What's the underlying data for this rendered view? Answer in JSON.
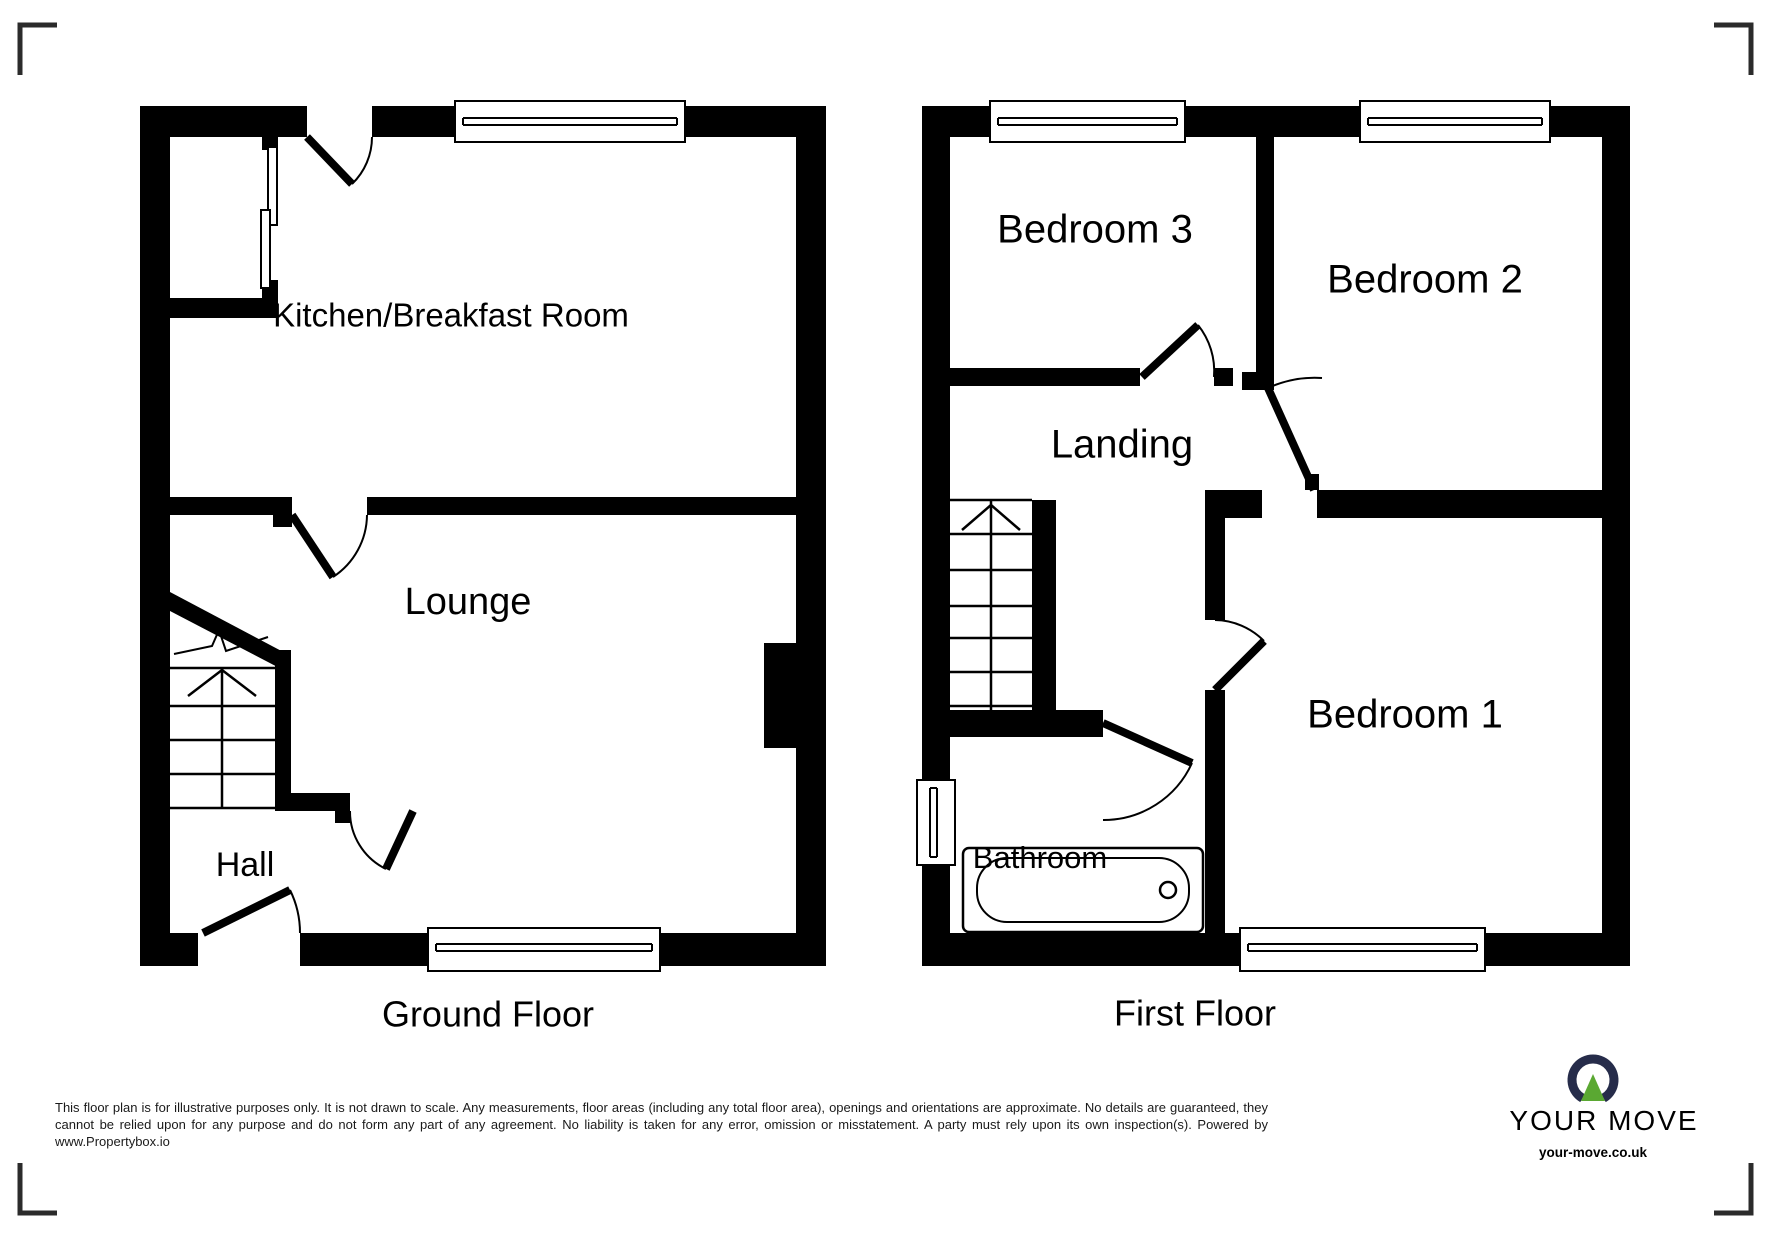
{
  "floors": {
    "ground": {
      "title": "Ground Floor",
      "rooms": {
        "kitchen": "Kitchen/Breakfast Room",
        "lounge": "Lounge",
        "hall": "Hall"
      }
    },
    "first": {
      "title": "First Floor",
      "rooms": {
        "bedroom3": "Bedroom 3",
        "bedroom2": "Bedroom 2",
        "bedroom1": "Bedroom 1",
        "landing": "Landing",
        "bathroom": "Bathroom"
      }
    }
  },
  "disclaimer": "This floor plan is for illustrative purposes only. It is not drawn to scale. Any measurements, floor areas (including any total floor area), openings and orientations are approximate. No details are guaranteed, they cannot be relied upon for any purpose and do not form any part of any agreement. No liability is taken for any error, omission or misstatement. A party must rely upon its own inspection(s). Powered by www.Propertybox.io",
  "logo": {
    "brand": "YOUR MOVE",
    "website": "your-move.co.uk",
    "navy": "#262c4a",
    "green": "#5aa832"
  },
  "colors": {
    "wall": "#000000",
    "background": "#ffffff",
    "corner_mark": "#2b2b2b"
  }
}
